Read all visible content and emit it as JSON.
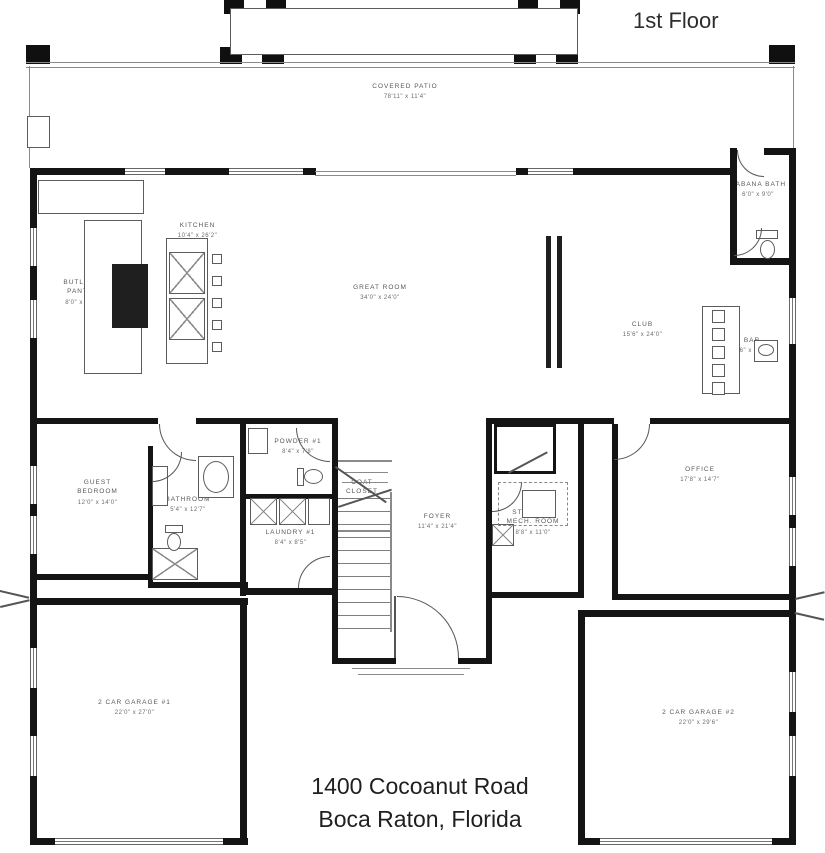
{
  "title": "1st Floor",
  "address": {
    "line1": "1400 Cocoanut Road",
    "line2": "Boca Raton, Florida"
  },
  "rooms": {
    "covered_patio": {
      "name": "COVERED PATIO",
      "dims": "78'11\" x 11'4\""
    },
    "cabana_bath": {
      "name": "CABANA BATH",
      "dims": "6'0\" x 9'0\""
    },
    "kitchen": {
      "name": "KITCHEN",
      "dims": "10'4\" x 26'2\""
    },
    "butlers_pantry": {
      "name": "BUTLER'S PANTRY",
      "dims": "8'0\" x 26'2\""
    },
    "great_room": {
      "name": "GREAT ROOM",
      "dims": "34'0\" x 24'0\""
    },
    "club": {
      "name": "CLUB",
      "dims": "15'6\" x 24'0\""
    },
    "bar": {
      "name": "BAR",
      "dims": "7'6\" x 16'0\""
    },
    "guest_bedroom": {
      "name": "GUEST BEDROOM",
      "dims": "12'0\" x 14'0\""
    },
    "bathroom": {
      "name": "BATHROOM",
      "dims": "5'4\" x 12'7\""
    },
    "powder": {
      "name": "POWDER #1",
      "dims": "8'4\" x 7'8\""
    },
    "coat_closet": {
      "name": "COAT CLOSET",
      "dims": ""
    },
    "laundry": {
      "name": "LAUNDRY #1",
      "dims": "8'4\" x 8'5\""
    },
    "foyer": {
      "name": "FOYER",
      "dims": "11'4\" x 21'4\""
    },
    "elevator": {
      "name": "ELEVATOR",
      "dims": ""
    },
    "storage_mech": {
      "name": "STORAGE/ MECH. ROOM",
      "dims": "8'8\" x 11'0\""
    },
    "office": {
      "name": "OFFICE",
      "dims": "17'8\" x 14'7\""
    },
    "garage_1": {
      "name": "2 CAR GARAGE #1",
      "dims": "22'0\" x 27'0\""
    },
    "garage_2": {
      "name": "2 CAR GARAGE #2",
      "dims": "22'0\" x 29'6\""
    }
  }
}
